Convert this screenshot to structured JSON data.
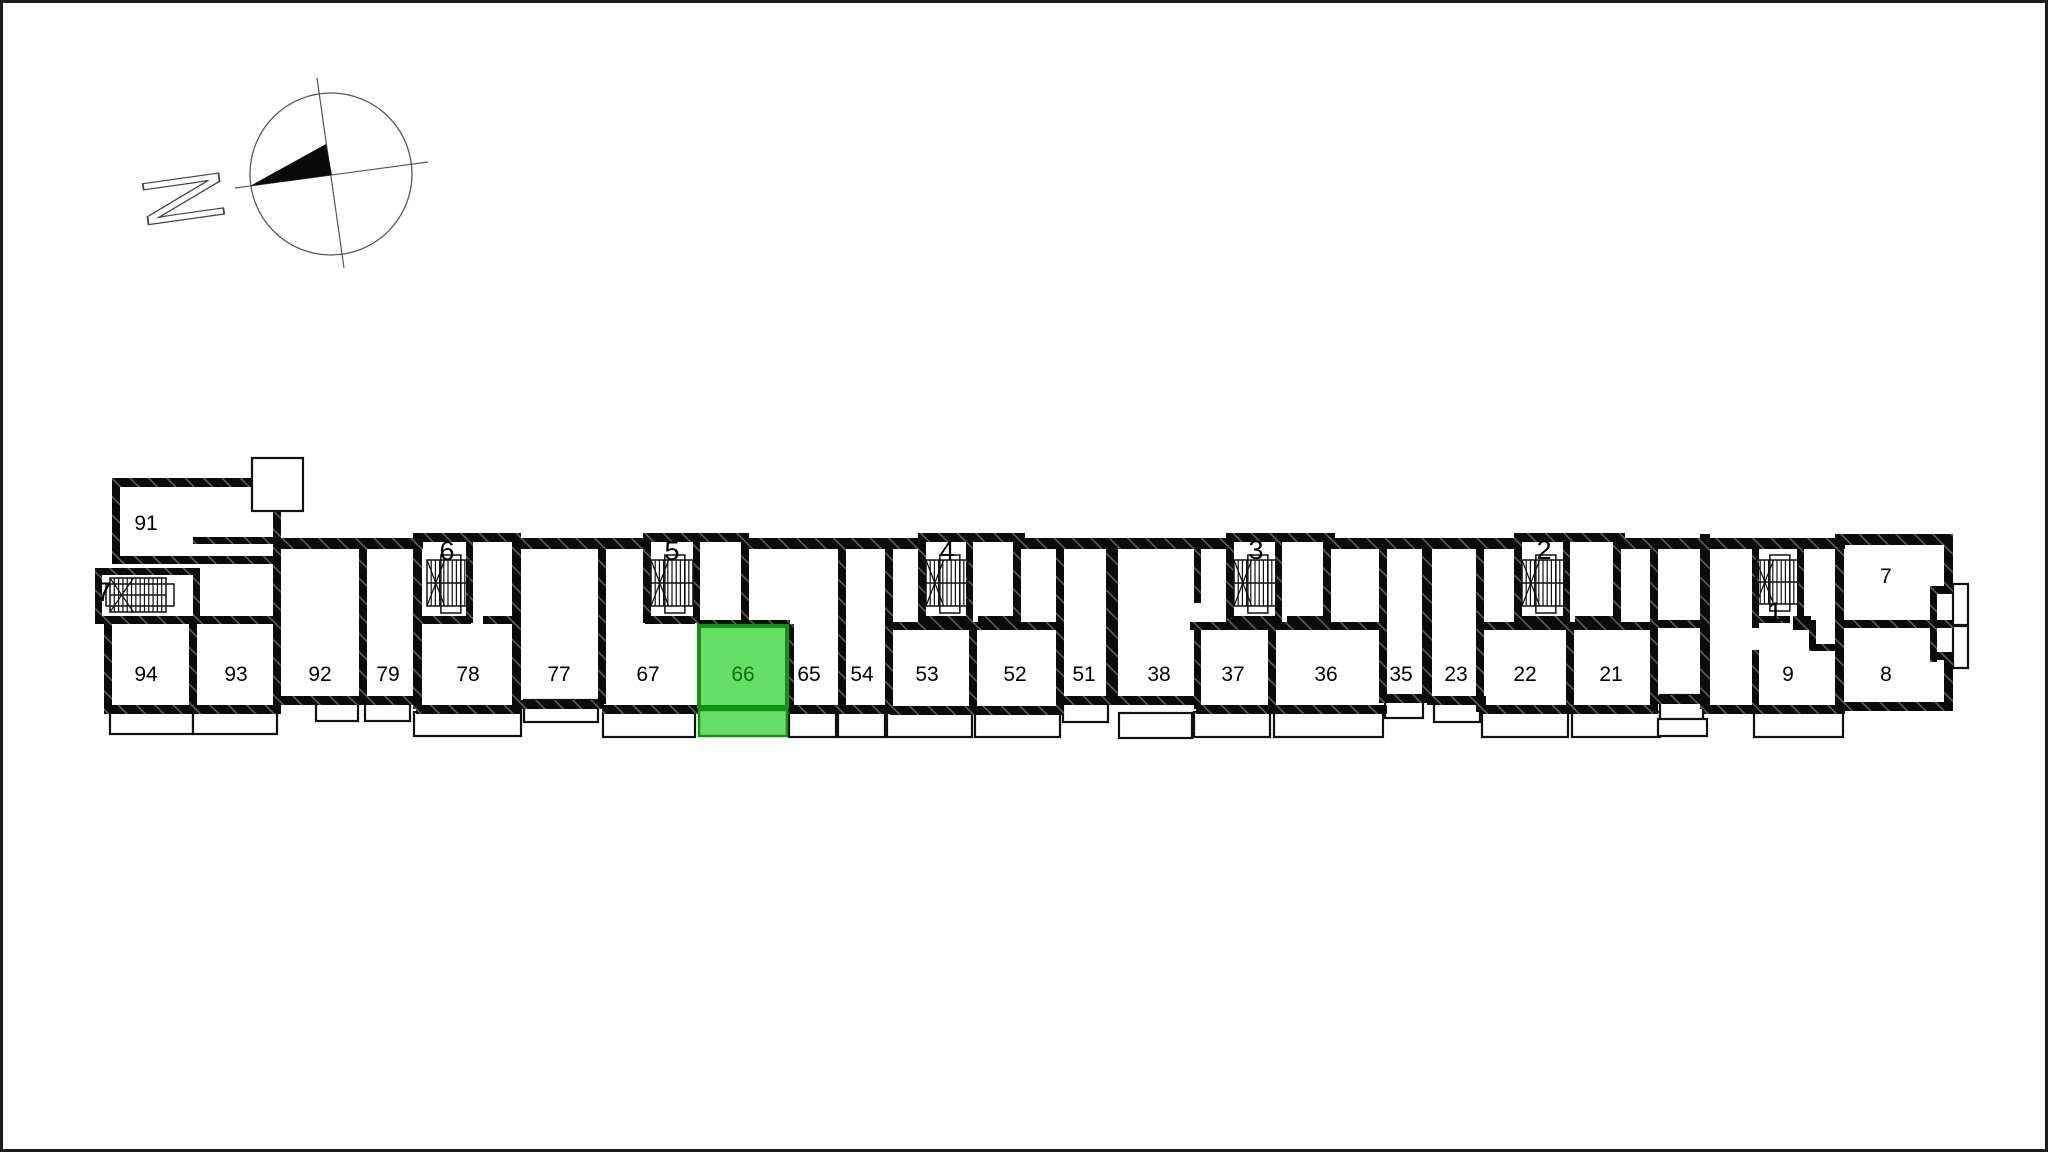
{
  "compass": {
    "letter": "N"
  },
  "plan": {
    "highlighted_unit": "66",
    "highlight_fill": "#66DE66",
    "highlight_border": "#129412",
    "highlight_text": "#0E6E0E",
    "wall_color": "#0b0b0b",
    "stairwells": [
      {
        "number": "7"
      },
      {
        "number": "6"
      },
      {
        "number": "5"
      },
      {
        "number": "4"
      },
      {
        "number": "3"
      },
      {
        "number": "2"
      },
      {
        "number": "1"
      }
    ],
    "units": [
      {
        "number": "91"
      },
      {
        "number": "94"
      },
      {
        "number": "93"
      },
      {
        "number": "92"
      },
      {
        "number": "79"
      },
      {
        "number": "78"
      },
      {
        "number": "77"
      },
      {
        "number": "67"
      },
      {
        "number": "66",
        "highlighted": true
      },
      {
        "number": "65"
      },
      {
        "number": "54"
      },
      {
        "number": "53"
      },
      {
        "number": "52"
      },
      {
        "number": "51"
      },
      {
        "number": "38"
      },
      {
        "number": "37"
      },
      {
        "number": "36"
      },
      {
        "number": "35"
      },
      {
        "number": "23"
      },
      {
        "number": "22"
      },
      {
        "number": "21"
      },
      {
        "number": "9"
      },
      {
        "number": "8"
      },
      {
        "number": "7"
      }
    ]
  }
}
